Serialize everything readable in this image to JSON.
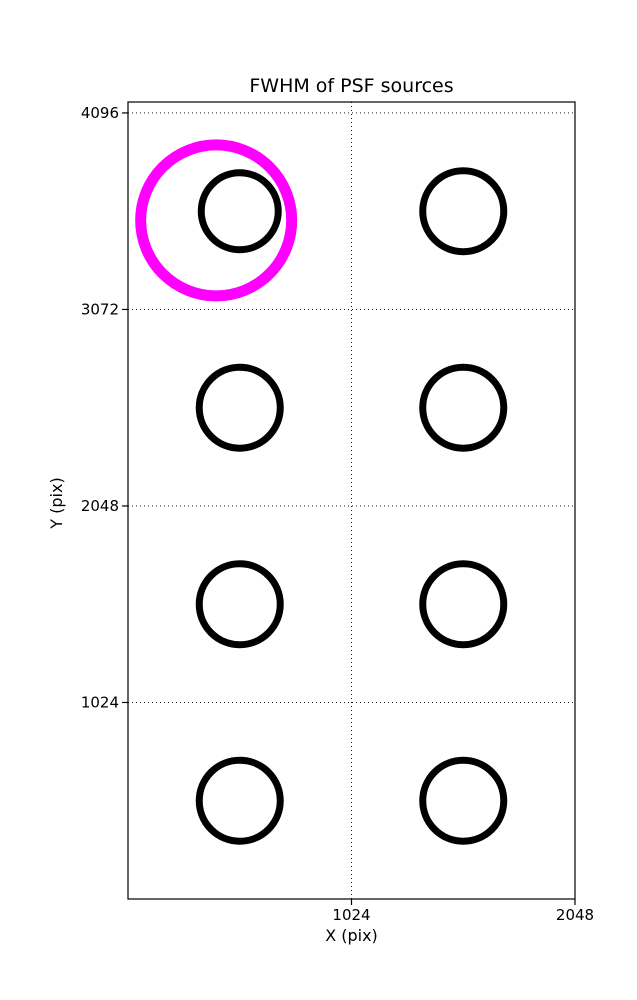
{
  "figure": {
    "background": "#ffffff"
  },
  "chart_data": {
    "type": "scatter",
    "title": "FWHM of PSF sources",
    "xlabel": "X (pix)",
    "ylabel": "Y (pix)",
    "xlim": [
      0,
      2048
    ],
    "ylim": [
      0,
      4153
    ],
    "xticks": [
      1024,
      2048
    ],
    "yticks": [
      1024,
      2048,
      3072,
      4096
    ],
    "grid": {
      "style": "dotted",
      "color": "#000000",
      "x_gridlines": [
        1024
      ],
      "y_gridlines": [
        1024,
        2048,
        3072,
        4096
      ]
    },
    "marker": {
      "shape": "circle",
      "fill": "none",
      "stroke": "#000000",
      "stroke_width_px": 7
    },
    "sources": [
      {
        "x": 512,
        "y": 3584,
        "marker_radius_px": 38.5
      },
      {
        "x": 1536,
        "y": 3584,
        "marker_radius_px": 40.5
      },
      {
        "x": 512,
        "y": 2560,
        "marker_radius_px": 40.5
      },
      {
        "x": 1536,
        "y": 2560,
        "marker_radius_px": 40.5
      },
      {
        "x": 512,
        "y": 1536,
        "marker_radius_px": 40.5
      },
      {
        "x": 1536,
        "y": 1536,
        "marker_radius_px": 40.5
      },
      {
        "x": 512,
        "y": 512,
        "marker_radius_px": 40.5
      },
      {
        "x": 1536,
        "y": 512,
        "marker_radius_px": 40.5
      }
    ],
    "highlight": {
      "x": 404,
      "y": 3536,
      "marker_radius_px": 75.5,
      "stroke": "#ff00ff",
      "stroke_width_px": 11
    }
  }
}
